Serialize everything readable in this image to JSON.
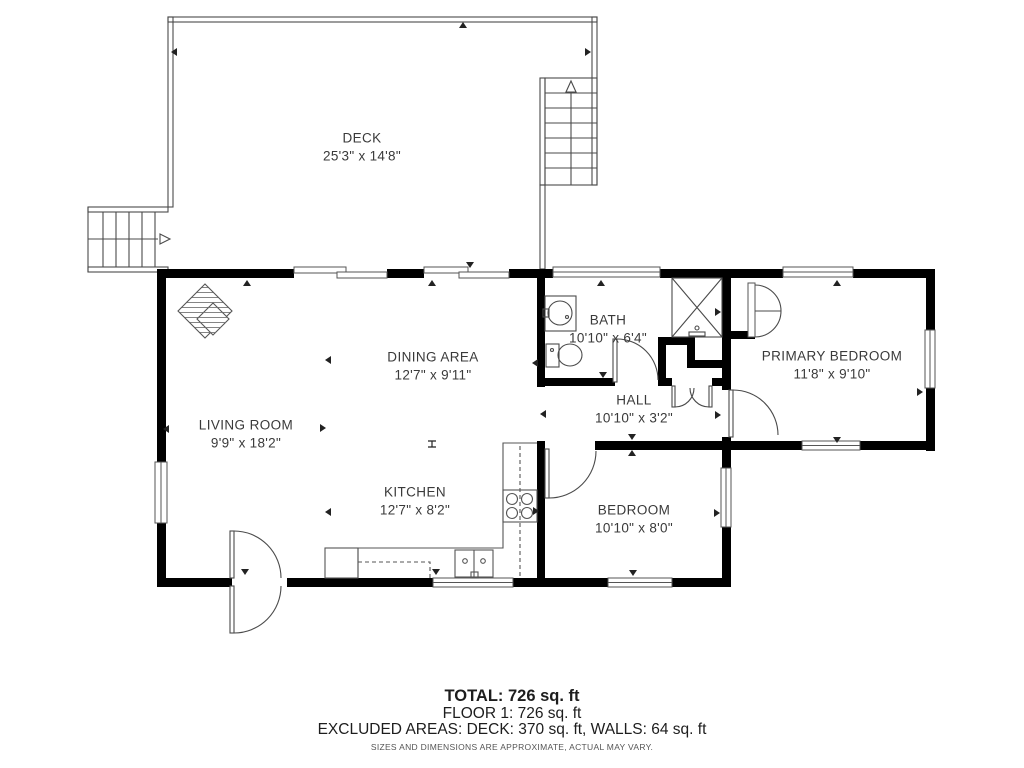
{
  "plan": {
    "rooms": [
      {
        "id": "deck",
        "name": "DECK",
        "dims": "25'3\" x 14'8\""
      },
      {
        "id": "living-room",
        "name": "LIVING ROOM",
        "dims": "9'9\" x 18'2\""
      },
      {
        "id": "dining-area",
        "name": "DINING AREA",
        "dims": "12'7\" x 9'11\""
      },
      {
        "id": "kitchen",
        "name": "KITCHEN",
        "dims": "12'7\" x 8'2\""
      },
      {
        "id": "bath",
        "name": "BATH",
        "dims": "10'10\" x 6'4\""
      },
      {
        "id": "hall",
        "name": "HALL",
        "dims": "10'10\" x 3'2\""
      },
      {
        "id": "primary-bedroom",
        "name": "PRIMARY BEDROOM",
        "dims": "11'8\" x 9'10\""
      },
      {
        "id": "bedroom",
        "name": "BEDROOM",
        "dims": "10'10\" x 8'0\""
      }
    ]
  },
  "summary": {
    "total": "TOTAL: 726 sq. ft",
    "floor1": "FLOOR 1: 726 sq. ft",
    "excluded": "EXCLUDED AREAS: DECK: 370 sq. ft, WALLS: 64 sq. ft",
    "disclaimer": "SIZES AND DIMENSIONS ARE APPROXIMATE, ACTUAL MAY VARY."
  },
  "colors": {
    "wall": "#000000",
    "thin_line": "#4a4a4a",
    "fixture_line": "#555555",
    "text": "#3a3a3a"
  }
}
